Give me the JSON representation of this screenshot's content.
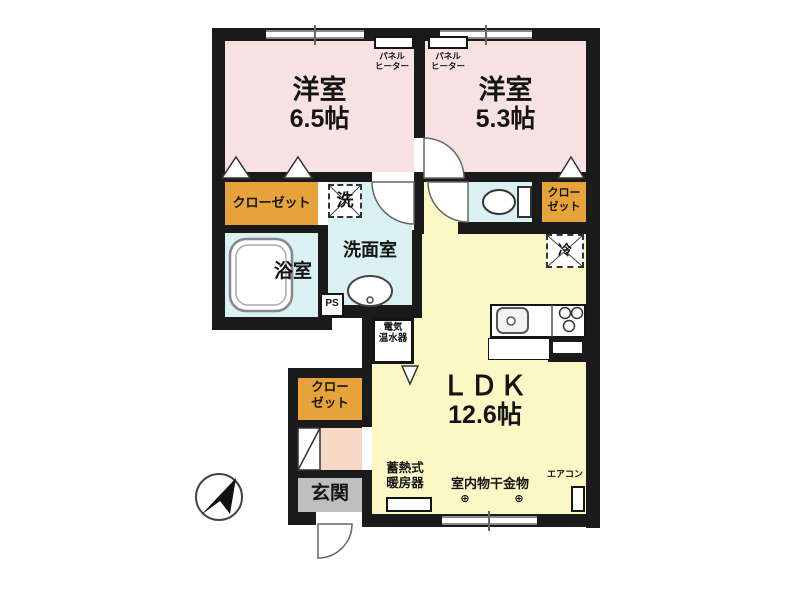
{
  "plan": {
    "rooms": {
      "bedroom1": {
        "label": "洋室",
        "size": "6.5帖"
      },
      "bedroom2": {
        "label": "洋室",
        "size": "5.3帖"
      },
      "ldk": {
        "label": "ＬＤＫ",
        "size": "12.6帖"
      },
      "bath": {
        "label": "浴室"
      },
      "washroom": {
        "label": "洗面室"
      },
      "entrance": {
        "label": "玄関"
      }
    },
    "closets": {
      "main": {
        "label": "クローゼット"
      },
      "wc_side": {
        "line1": "クロー",
        "line2": "ゼット"
      },
      "entry": {
        "line1": "クロー",
        "line2": "ゼット"
      }
    },
    "equipment": {
      "panel_heater": {
        "line1": "パネル",
        "line2": "ヒーター"
      },
      "washer": {
        "label": "洗"
      },
      "pipe_space": {
        "label": "PS"
      },
      "water_heater": {
        "line1": "電気",
        "line2": "温水器"
      },
      "fridge": {
        "label": "冷"
      },
      "storage_heater": {
        "line1": "蓄熱式",
        "line2": "暖房器"
      },
      "laundry": {
        "label": "室内物干金物",
        "anchor": "⊕"
      },
      "aircon": {
        "label": "エアコン"
      }
    },
    "colors": {
      "wall": "#1a1a1a",
      "bedroom": "#f8e1e1",
      "ldk": "#fbf8c6",
      "wet_area": "#d9f1f2",
      "closet": "#e7a33b",
      "hall": "#f7d8c6",
      "entrance_floor": "#bfbfbf"
    }
  }
}
